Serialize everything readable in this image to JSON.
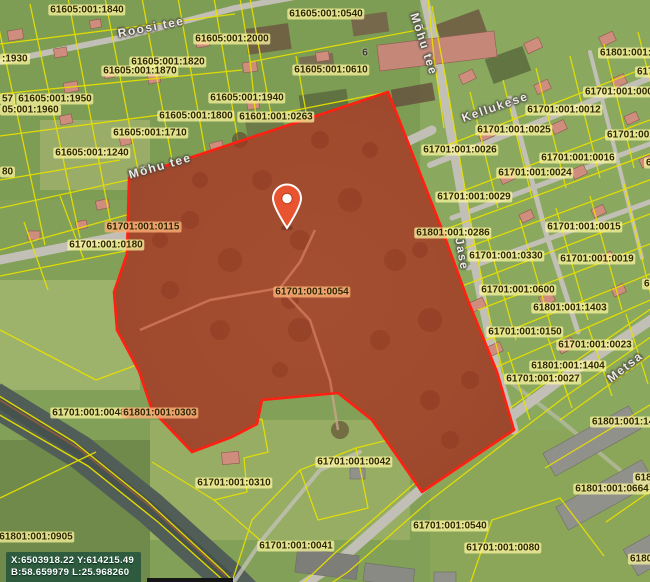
{
  "map": {
    "colors": {
      "cadastral_line": "#e8e000",
      "highlight_stroke": "#ff2012",
      "highlight_fill": "rgba(226,62,26,0.40)",
      "pin_fill": "#e8542f",
      "label_bg": "rgba(252,246,160,0.72)",
      "label_bg_hl": "rgba(255,176,118,0.78)",
      "coords_bg": "rgba(28,78,58,0.78)",
      "water": "#515e58",
      "road": "#c2c0b6"
    },
    "parcel_labels": [
      {
        "text": "61605:001:1840",
        "x": 87,
        "y": 10
      },
      {
        "text": "61605:001:0540",
        "x": 326,
        "y": 14
      },
      {
        "text": "61605:001:2000",
        "x": 232,
        "y": 39
      },
      {
        "text": "61801:001:0",
        "x": 598,
        "y": 53,
        "align": "left"
      },
      {
        "text": ":1930",
        "x": 0,
        "y": 59,
        "align": "left"
      },
      {
        "text": "61605:001:1820",
        "x": 168,
        "y": 62
      },
      {
        "text": "61605:001:1870",
        "x": 140,
        "y": 71
      },
      {
        "text": "61605:001:0610",
        "x": 331,
        "y": 70
      },
      {
        "text": "617",
        "x": 635,
        "y": 72,
        "align": "left"
      },
      {
        "text": "61701:001:000",
        "x": 583,
        "y": 92,
        "align": "left"
      },
      {
        "text": "57",
        "x": 0,
        "y": 99,
        "align": "left"
      },
      {
        "text": "61605:001:1950",
        "x": 55,
        "y": 99
      },
      {
        "text": "61605:001:1940",
        "x": 247,
        "y": 98
      },
      {
        "text": "05:001:1960",
        "x": 0,
        "y": 110,
        "align": "left"
      },
      {
        "text": "61701:001:0012",
        "x": 564,
        "y": 110
      },
      {
        "text": "61605:001:1800",
        "x": 196,
        "y": 116
      },
      {
        "text": "61601:001:0263",
        "x": 276,
        "y": 117
      },
      {
        "text": "61701:001:0025",
        "x": 514,
        "y": 130
      },
      {
        "text": "61605:001:1710",
        "x": 150,
        "y": 133
      },
      {
        "text": "61701:001:",
        "x": 605,
        "y": 135,
        "align": "left"
      },
      {
        "text": "61701:001:0026",
        "x": 460,
        "y": 150
      },
      {
        "text": "61605:001:1240",
        "x": 92,
        "y": 153
      },
      {
        "text": "61701:001:0016",
        "x": 578,
        "y": 158
      },
      {
        "text": "6",
        "x": 644,
        "y": 163,
        "align": "left"
      },
      {
        "text": "80",
        "x": 0,
        "y": 172,
        "align": "left"
      },
      {
        "text": "61701:001:0024",
        "x": 535,
        "y": 173
      },
      {
        "text": "61701:001:0029",
        "x": 474,
        "y": 197
      },
      {
        "text": "61701:001:0115",
        "x": 143,
        "y": 227,
        "highlight": true
      },
      {
        "text": "61701:001:0015",
        "x": 584,
        "y": 227
      },
      {
        "text": "61801:001:0286",
        "x": 453,
        "y": 233
      },
      {
        "text": "61701:001:0180",
        "x": 106,
        "y": 245
      },
      {
        "text": "61701:001:0330",
        "x": 506,
        "y": 256
      },
      {
        "text": "61701:001:0019",
        "x": 597,
        "y": 259
      },
      {
        "text": "6170",
        "x": 642,
        "y": 284,
        "align": "left"
      },
      {
        "text": "61701:001:0600",
        "x": 518,
        "y": 290
      },
      {
        "text": "61701:001:0054",
        "x": 312,
        "y": 292,
        "highlight": true
      },
      {
        "text": "61801:001:1403",
        "x": 570,
        "y": 308
      },
      {
        "text": "61701:001:0150",
        "x": 525,
        "y": 332
      },
      {
        "text": "61701:001:0023",
        "x": 595,
        "y": 345
      },
      {
        "text": "61801:001:1404",
        "x": 568,
        "y": 366
      },
      {
        "text": "61701:001:0027",
        "x": 543,
        "y": 379
      },
      {
        "text": "61701:001:0048",
        "x": 89,
        "y": 413
      },
      {
        "text": "61801:001:0303",
        "x": 160,
        "y": 413,
        "highlight": true
      },
      {
        "text": "61801:001:142",
        "x": 590,
        "y": 422,
        "align": "left"
      },
      {
        "text": "61701:001:0042",
        "x": 354,
        "y": 462
      },
      {
        "text": "6180",
        "x": 633,
        "y": 478,
        "align": "left"
      },
      {
        "text": "61701:001:0310",
        "x": 234,
        "y": 483
      },
      {
        "text": "61801:001:0664",
        "x": 612,
        "y": 489
      },
      {
        "text": "61701:001:0540",
        "x": 450,
        "y": 526
      },
      {
        "text": "61801:001:0905",
        "x": 36,
        "y": 537
      },
      {
        "text": "61701:001:0041",
        "x": 296,
        "y": 546
      },
      {
        "text": "61701:001:0080",
        "x": 503,
        "y": 548
      },
      {
        "text": "61801",
        "x": 628,
        "y": 559,
        "align": "left"
      }
    ],
    "street_labels": [
      {
        "text": "Roosi tee",
        "x": 151,
        "y": 27,
        "angle": -11
      },
      {
        "text": "Mõhu tee",
        "x": 424,
        "y": 44,
        "angle": 72
      },
      {
        "text": "Mõhu tee",
        "x": 160,
        "y": 166,
        "angle": -16
      },
      {
        "text": "Kellukese",
        "x": 495,
        "y": 107,
        "angle": -19
      },
      {
        "text": "Jase",
        "x": 462,
        "y": 254,
        "angle": 80
      },
      {
        "text": "Metsa",
        "x": 625,
        "y": 367,
        "angle": -38
      }
    ],
    "building_labels": [
      {
        "text": "6",
        "x": 365,
        "y": 53
      }
    ],
    "overlay": {
      "line1": "X:6503918.22 Y:614215.49",
      "line2": "B:58.659979 L:25.968260"
    },
    "pin": {
      "x": 287,
      "y": 205
    }
  }
}
